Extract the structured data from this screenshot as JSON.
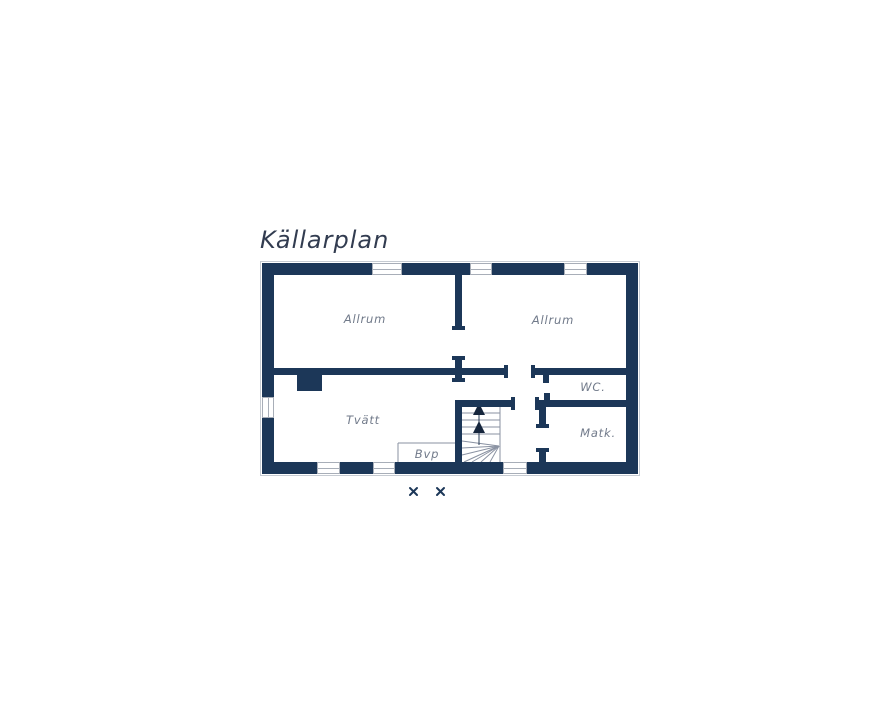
{
  "title": "Källarplan",
  "colors": {
    "wall": "#1c3758",
    "label": "#717a8a",
    "title": "#323c50",
    "outline": "#c6cbd2",
    "stair": "#8a92a2"
  },
  "rooms": {
    "allrum_left": "Allrum",
    "allrum_right": "Allrum",
    "wc": "WC.",
    "tvatt": "Tvätt",
    "matk": "Matk.",
    "bvp": "Bvp"
  },
  "stairs": {
    "direction": "up",
    "arrow_count": 2
  }
}
